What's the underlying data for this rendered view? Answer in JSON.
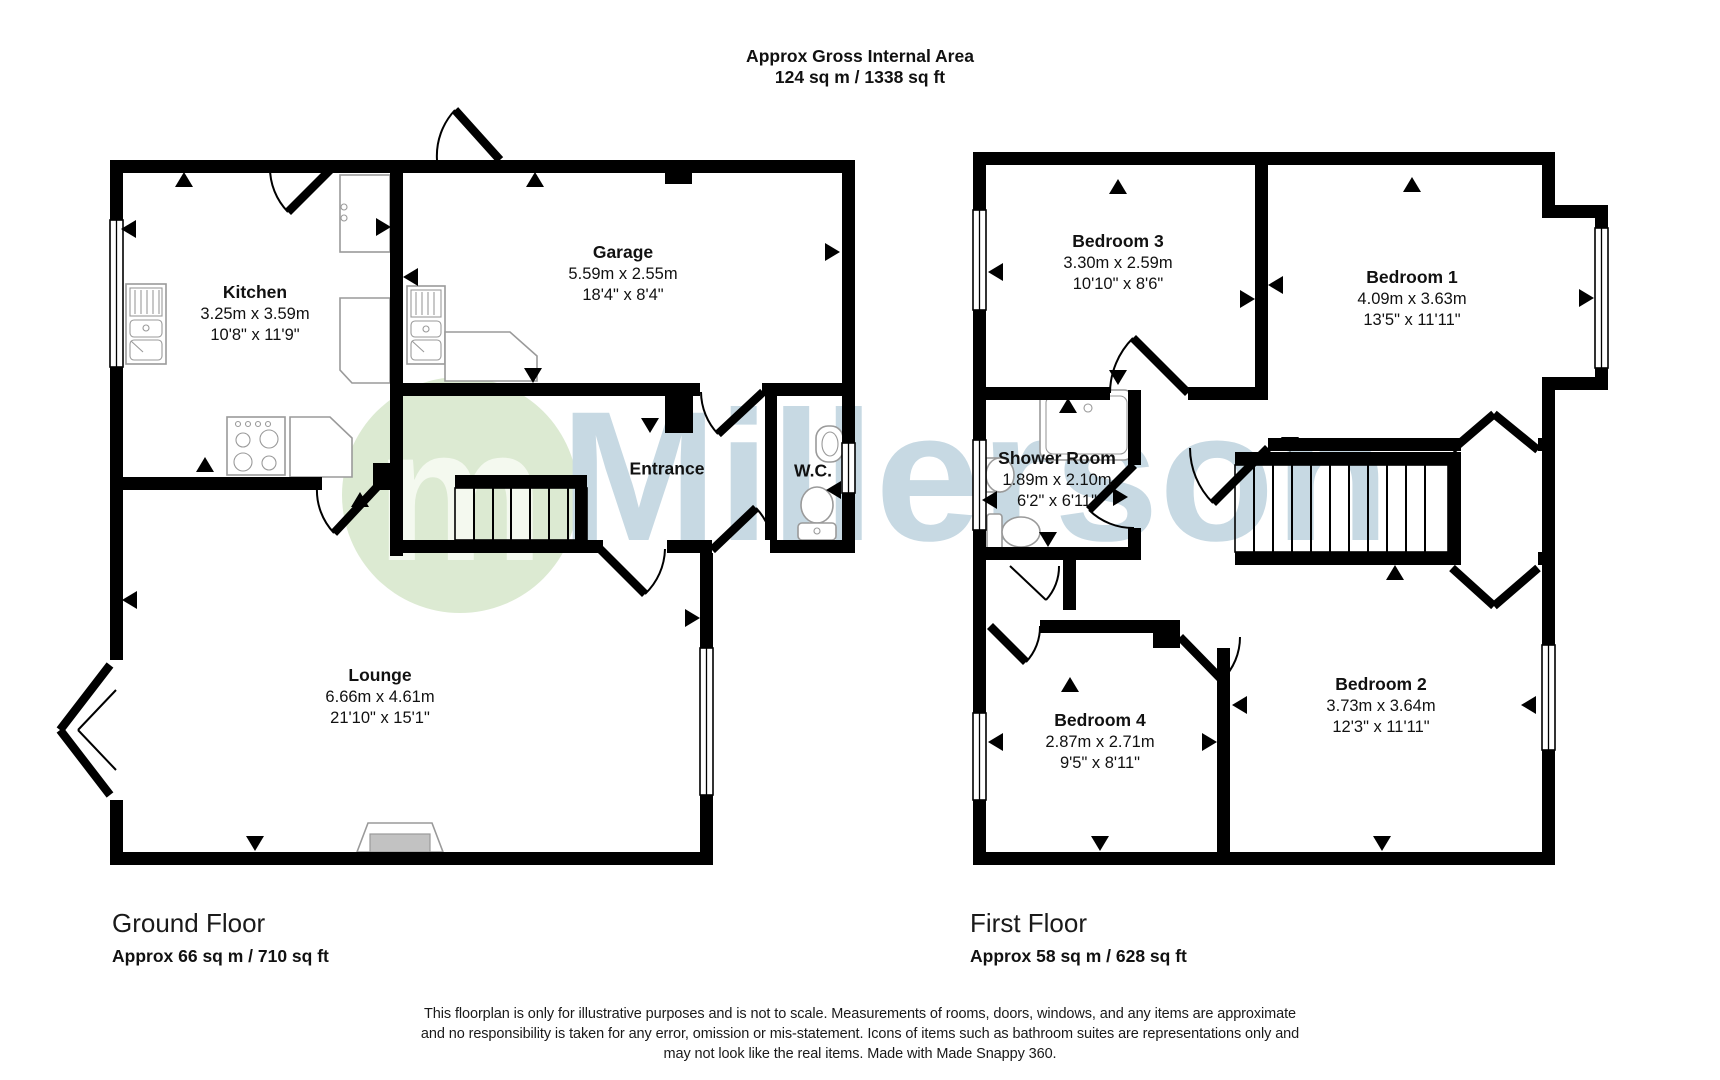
{
  "title": {
    "line1": "Approx Gross Internal Area",
    "line2": "124 sq m / 1338 sq ft"
  },
  "watermark": {
    "logo_letter": "m",
    "brand": "Millerson",
    "logo_color": "#dcead2",
    "logo_letter_color": "#f4f9ef",
    "text_color": "#c7d9e3"
  },
  "floors": {
    "ground": {
      "name": "Ground Floor",
      "area": "Approx 66 sq m / 710 sq ft",
      "rooms": {
        "kitchen": {
          "name": "Kitchen",
          "metric": "3.25m x 3.59m",
          "imperial": "10'8\" x 11'9\""
        },
        "garage": {
          "name": "Garage",
          "metric": "5.59m x 2.55m",
          "imperial": "18'4\" x 8'4\""
        },
        "entrance": {
          "name": "Entrance"
        },
        "wc": {
          "name": "W.C."
        },
        "lounge": {
          "name": "Lounge",
          "metric": "6.66m x 4.61m",
          "imperial": "21'10\" x 15'1\""
        }
      }
    },
    "first": {
      "name": "First Floor",
      "area": "Approx 58 sq m / 628 sq ft",
      "rooms": {
        "bedroom3": {
          "name": "Bedroom 3",
          "metric": "3.30m x 2.59m",
          "imperial": "10'10\" x 8'6\""
        },
        "bedroom1": {
          "name": "Bedroom 1",
          "metric": "4.09m x 3.63m",
          "imperial": "13'5\" x 11'11\""
        },
        "shower": {
          "name": "Shower Room",
          "metric": "1.89m x 2.10m",
          "imperial": "6'2\" x 6'11\""
        },
        "bedroom4": {
          "name": "Bedroom 4",
          "metric": "2.87m x 2.71m",
          "imperial": "9'5\" x 8'11\""
        },
        "bedroom2": {
          "name": "Bedroom 2",
          "metric": "3.73m x 3.64m",
          "imperial": "12'3\" x 11'11\""
        }
      }
    }
  },
  "disclaimer": {
    "line1": "This floorplan is only for illustrative purposes and is not to scale. Measurements of rooms, doors, windows, and any items are approximate",
    "line2": "and no responsibility is taken for any error, omission or mis-statement. Icons of items such as bathroom suites are representations only and",
    "line3": "may not look like the real items. Made with Made Snappy 360."
  }
}
